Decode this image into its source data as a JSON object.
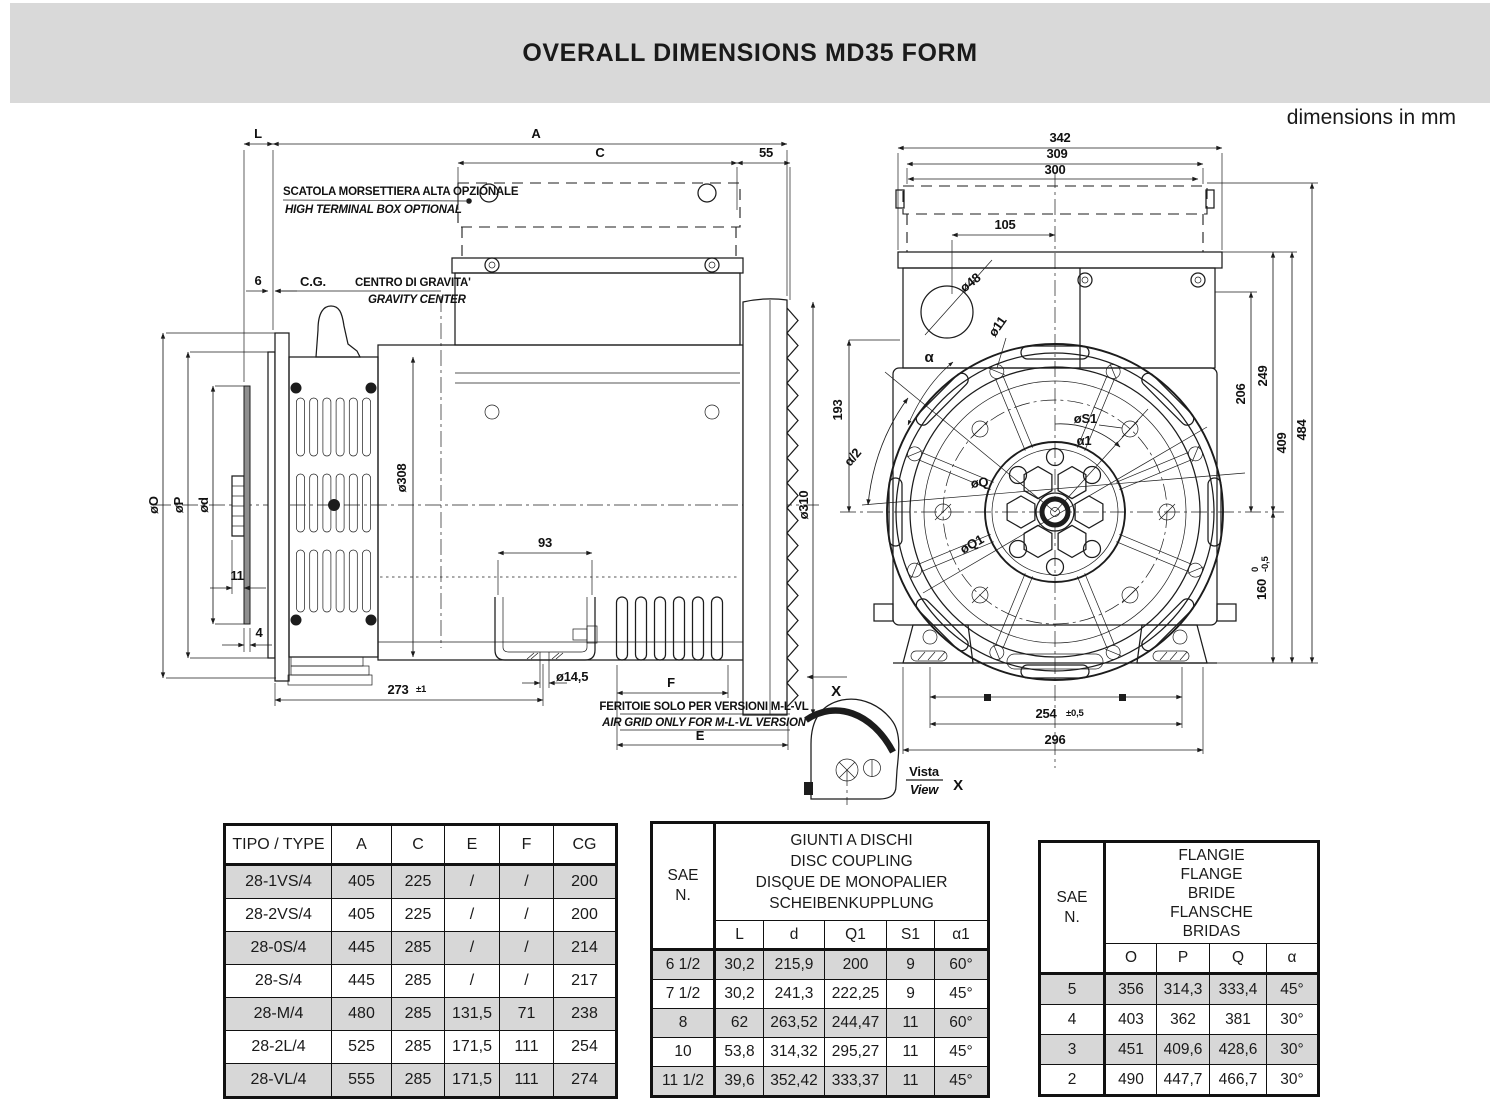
{
  "page": {
    "title": "OVERALL DIMENSIONS MD35 FORM",
    "units_note": "dimensions in mm"
  },
  "side_view": {
    "notes": {
      "terminal_box_it": "SCATOLA MORSETTIERA ALTA OPZIONALE",
      "terminal_box_en": "HIGH TERMINAL BOX OPTIONAL",
      "cg_abbr": "C.G.",
      "cg_it": "CENTRO DI GRAVITA'",
      "cg_en": "GRAVITY CENTER",
      "air_grid_it": "FERITOIE SOLO PER VERSIONI  M-L-VL",
      "air_grid_en": "AIR GRID ONLY FOR  M-L-VL  VERSION"
    },
    "dims": {
      "L": "L",
      "A": "A",
      "C": "C",
      "n55": "55",
      "n6": "6",
      "phiO": "øO",
      "phiP": "øP",
      "phid": "ød",
      "n11": "11",
      "n4": "4",
      "n273": "273",
      "n273_tol": "±1",
      "phi308": "ø308",
      "n93": "93",
      "phi14_5": "ø14,5",
      "F": "F",
      "E": "E",
      "phi310": "ø310",
      "x_arrow": "X"
    }
  },
  "front_view": {
    "dims": {
      "n342": "342",
      "n309": "309",
      "n300": "300",
      "n105": "105",
      "phi48": "ø48",
      "phi11": "ø11",
      "alpha": "α",
      "alpha_half": "α/2",
      "n193": "193",
      "phiS1": "øS1",
      "alpha1": "α1",
      "phiQ": "øQ",
      "phiQ1": "øQ1",
      "n206": "206",
      "n249": "249",
      "n409": "409",
      "n484": "484",
      "n160": "160",
      "n160_tol_hi": "0",
      "n160_tol_lo": "-0,5",
      "n254": "254",
      "n254_tol": "±0,5",
      "n296": "296"
    },
    "view_detail": {
      "it": "Vista",
      "en": "View",
      "ref": "X"
    }
  },
  "tables": {
    "type_table": {
      "headers": [
        "TIPO / TYPE",
        "A",
        "C",
        "E",
        "F",
        "CG"
      ],
      "rows": [
        [
          "28-1VS/4",
          "405",
          "225",
          "/",
          "/",
          "200"
        ],
        [
          "28-2VS/4",
          "405",
          "225",
          "/",
          "/",
          "200"
        ],
        [
          "28-0S/4",
          "445",
          "285",
          "/",
          "/",
          "214"
        ],
        [
          "28-S/4",
          "445",
          "285",
          "/",
          "/",
          "217"
        ],
        [
          "28-M/4",
          "480",
          "285",
          "131,5",
          "71",
          "238"
        ],
        [
          "28-2L/4",
          "525",
          "285",
          "171,5",
          "111",
          "254"
        ],
        [
          "28-VL/4",
          "555",
          "285",
          "171,5",
          "111",
          "274"
        ]
      ]
    },
    "coupling_table": {
      "sae_line1": "SAE",
      "sae_line2": "N.",
      "title_lines": [
        "GIUNTI A DISCHI",
        "DISC COUPLING",
        "DISQUE DE MONOPALIER",
        "SCHEIBENKUPPLUNG"
      ],
      "headers": [
        "L",
        "d",
        "Q1",
        "S1",
        "α1"
      ],
      "rows": [
        [
          "6 1/2",
          "30,2",
          "215,9",
          "200",
          "9",
          "60°"
        ],
        [
          "7 1/2",
          "30,2",
          "241,3",
          "222,25",
          "9",
          "45°"
        ],
        [
          "8",
          "62",
          "263,52",
          "244,47",
          "11",
          "60°"
        ],
        [
          "10",
          "53,8",
          "314,32",
          "295,27",
          "11",
          "45°"
        ],
        [
          "11 1/2",
          "39,6",
          "352,42",
          "333,37",
          "11",
          "45°"
        ]
      ]
    },
    "flange_table": {
      "sae_line1": "SAE",
      "sae_line2": "N.",
      "title_lines": [
        "FLANGIE",
        "FLANGE",
        "BRIDE",
        "FLANSCHE",
        "BRIDAS"
      ],
      "headers": [
        "O",
        "P",
        "Q",
        "α"
      ],
      "rows": [
        [
          "5",
          "356",
          "314,3",
          "333,4",
          "45°"
        ],
        [
          "4",
          "403",
          "362",
          "381",
          "30°"
        ],
        [
          "3",
          "451",
          "409,6",
          "428,6",
          "30°"
        ],
        [
          "2",
          "490",
          "447,7",
          "466,7",
          "30°"
        ]
      ]
    }
  }
}
